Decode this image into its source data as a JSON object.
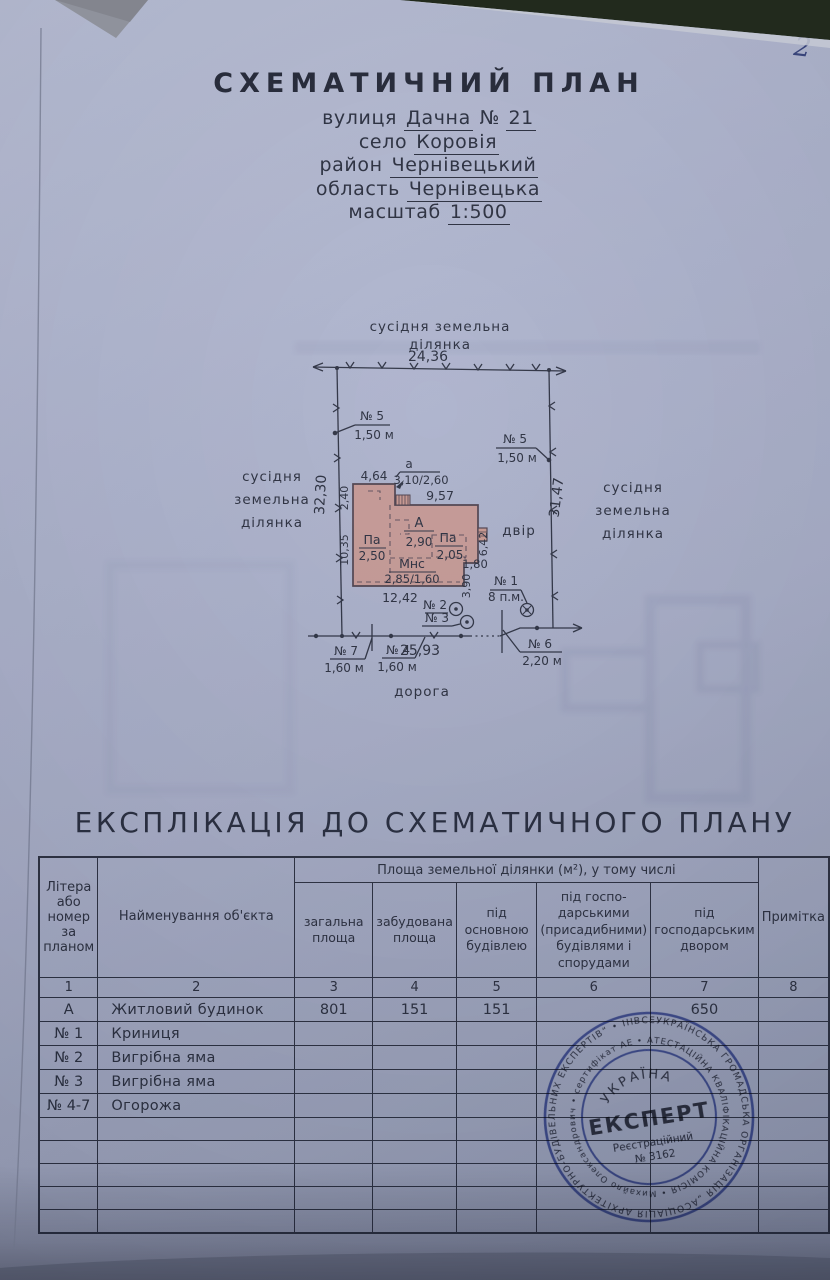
{
  "page": {
    "number": "2"
  },
  "title_block": {
    "title": "СХЕМАТИЧНИЙ  ПЛАН",
    "street_label": "вулиця",
    "street_value": "Дачна",
    "street_num_sign": "№",
    "street_num": "21",
    "village_label": "село",
    "village_value": "Коровія",
    "district_label": "район",
    "district_value": "Чернівецький",
    "region_label": "область",
    "region_value": "Чернівецька",
    "scale_label": "масштаб",
    "scale_value": "1:500"
  },
  "plan": {
    "neighbor_top_line1": "сусідня земельна",
    "neighbor_top_line2": "ділянка",
    "neighbor_word1": "сусідня",
    "neighbor_word2": "земельна",
    "neighbor_word3": "ділянка",
    "yard": "двір",
    "road": "дорога",
    "dim_top": "24,36",
    "dim_left": "32,30",
    "dim_right": "31,47",
    "dim_bottom": "25,93",
    "house": {
      "annex_width": "4,64",
      "annex_height": "2,40",
      "annex_letter": "а",
      "annex_frac": "3,10/2,60",
      "main_width": "9,57",
      "left_height": "10,35",
      "room_a": "А",
      "room_a_val": "2,90",
      "room_pa_left": "Па",
      "room_pa_left_val": "2,50",
      "room_pa_right": "Па",
      "room_pa_right_val": "2,05",
      "room_mns": "Мнс",
      "room_mns_val": "2,85/1,60",
      "bottom_width": "12,42",
      "step_h1": "1,80",
      "step_h2": "3,90",
      "right_height": "6,42"
    },
    "markers": {
      "n5l_no": "№ 5",
      "n5l_len": "1,50 м",
      "n5r_no": "№ 5",
      "n5r_len": "1,50 м",
      "n1_no": "№ 1",
      "n1_len": "8 п.м.",
      "n2_no": "№ 2",
      "n3_no": "№ 3",
      "n7_no": "№ 7",
      "n7_len": "1,60 м",
      "n4_no": "№ 4",
      "n4_len": "1,60 м",
      "n6_no": "№ 6",
      "n6_len": "2,20 м"
    }
  },
  "explication": {
    "title": "ЕКСПЛІКАЦІЯ  ДО  СХЕМАТИЧНОГО  ПЛАНУ",
    "header": {
      "col1": "Літера або номер за планом",
      "col2": "Найменування об'єкта",
      "area_span": "Площа земельної ділянки (м²), у тому числі",
      "col3": "загальна площа",
      "col4": "забудована площа",
      "col5": "під основною будівлею",
      "col6": "під госпо-дарськими (присадибними) будівлями і спорудами",
      "col7": "під господарським двором",
      "col8": "Примітка"
    },
    "col_numbers": [
      "1",
      "2",
      "3",
      "4",
      "5",
      "6",
      "7",
      "8"
    ],
    "rows": [
      {
        "c1": "А",
        "c2": "Житловий будинок",
        "c3": "801",
        "c4": "151",
        "c5": "151",
        "c6": "",
        "c7": "650",
        "c8": ""
      },
      {
        "c1": "№ 1",
        "c2": "Криниця",
        "c3": "",
        "c4": "",
        "c5": "",
        "c6": "",
        "c7": "",
        "c8": ""
      },
      {
        "c1": "№ 2",
        "c2": "Вигрібна яма",
        "c3": "",
        "c4": "",
        "c5": "",
        "c6": "",
        "c7": "",
        "c8": ""
      },
      {
        "c1": "№ 3",
        "c2": "Вигрібна яма",
        "c3": "",
        "c4": "",
        "c5": "",
        "c6": "",
        "c7": "",
        "c8": ""
      },
      {
        "c1": "№ 4-7",
        "c2": "Огорожа",
        "c3": "",
        "c4": "",
        "c5": "",
        "c6": "",
        "c7": "",
        "c8": ""
      }
    ]
  },
  "stamp": {
    "country": "УКРАЇНА",
    "main": "ЕКСПЕРТ",
    "reg_label": "Реєстраційний",
    "reg_number": "№ 3162",
    "ring_outer": "ВСЕУКРАЇНСЬКА ГРОМАДСЬКА ОРГАНІЗАЦІЯ „АСОЦІАЦІЯ АРХІТЕКТУРНО-БУДІВЕЛЬНИХ ЕКСПЕРТІВ“ • ІНВЕНТАРИЗАЦІЯ •",
    "ring_inner": "• АТЕСТАЦІЙНА КВАЛІФІКАЦІЙНА КОМІСІЯ • Михайло Олександрович • сертифікат АЕ №"
  },
  "colors": {
    "paper": "#aab0ca",
    "ink": "#262b3b",
    "house_fill": "#c6958e",
    "stamp_blue": "#4b60b3"
  }
}
